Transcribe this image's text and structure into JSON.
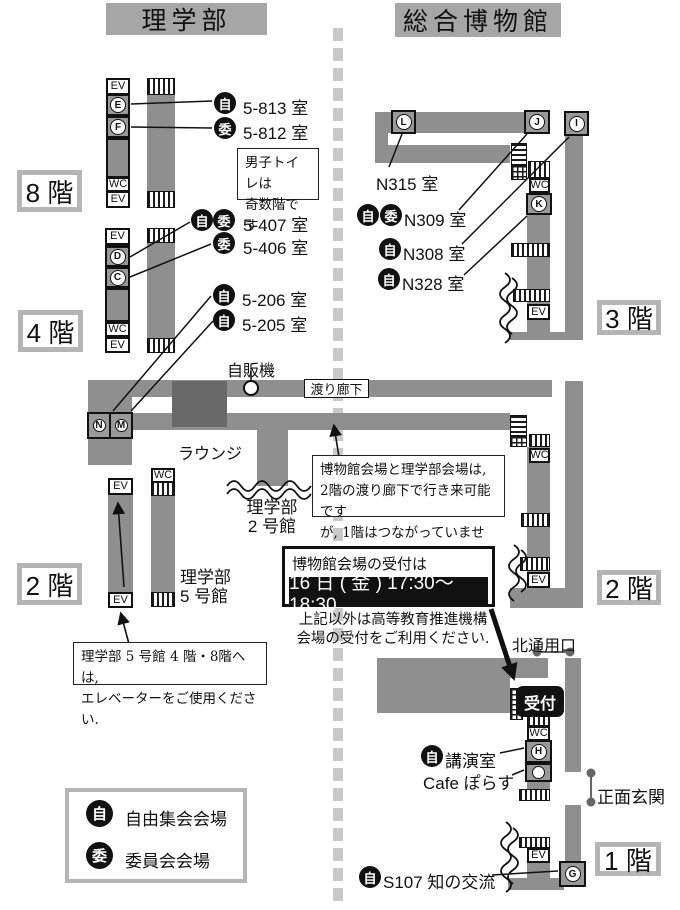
{
  "headers": {
    "left": "理学部",
    "right": "総合博物館"
  },
  "floor_tags": {
    "f8": "8 階",
    "f4": "4 階",
    "f2": "2 階",
    "f3": "3 階",
    "f1": "1 階"
  },
  "map": {
    "ev": "EV",
    "wc": "WC",
    "reception": "受付"
  },
  "letters": {
    "E": "E",
    "F": "F",
    "D": "D",
    "C": "C",
    "N": "N",
    "M": "M",
    "L": "L",
    "J": "J",
    "I": "I",
    "K": "K",
    "H": "H",
    "G": "G"
  },
  "badges": {
    "free": "自",
    "committee": "委"
  },
  "rooms": {
    "r5813": "5-813 室",
    "r5812": "5-812 室",
    "r5407": "5-407 室",
    "r5406": "5-406 室",
    "r5206": "5-206 室",
    "r5205": "5-205 室",
    "n315": "N315 室",
    "n309": "N309 室",
    "n308": "N308 室",
    "n328": "N328 室",
    "lecture": "講演室",
    "cafe": "Cafe ぽらす",
    "s107": "S107 知の交流"
  },
  "labels": {
    "vending": "自販機",
    "corridor": "渡り廊下",
    "lounge": "ラウンジ",
    "bldg2_l1": "理学部",
    "bldg2_l2": "2 号館",
    "bldg5_l1": "理学部",
    "bldg5_l2": "5 号館",
    "north_gate": "北通用口",
    "main_entrance": "正面玄関"
  },
  "notes": {
    "mens": [
      "男子トイレは",
      "奇数階です"
    ],
    "corridor_note": [
      "博物館会場と理学部会場は,",
      "2階の渡り廊下で行き来可能です",
      "が, 1階はつながっていません."
    ],
    "elevator_note": [
      "理学部 5 号館 4 階・8階へは,",
      "エレベーターをご使用ください."
    ],
    "reception_title": "博物館会場の受付は",
    "reception_time": "16 日 ( 金 ) 17:30〜18:30",
    "other_reception": [
      "上記以外は高等教育推進機構",
      "会場の受付をご利用ください."
    ]
  },
  "legend": {
    "free": "自由集会会場",
    "committee": "委員会会場"
  },
  "colors": {
    "plan_gray": "#8f8f8f",
    "dark_gray": "#696969",
    "header_gray": "#a6a6a6",
    "tag_border": "#b5b5b5",
    "black": "#111111",
    "dash": "#c9c9c9"
  }
}
